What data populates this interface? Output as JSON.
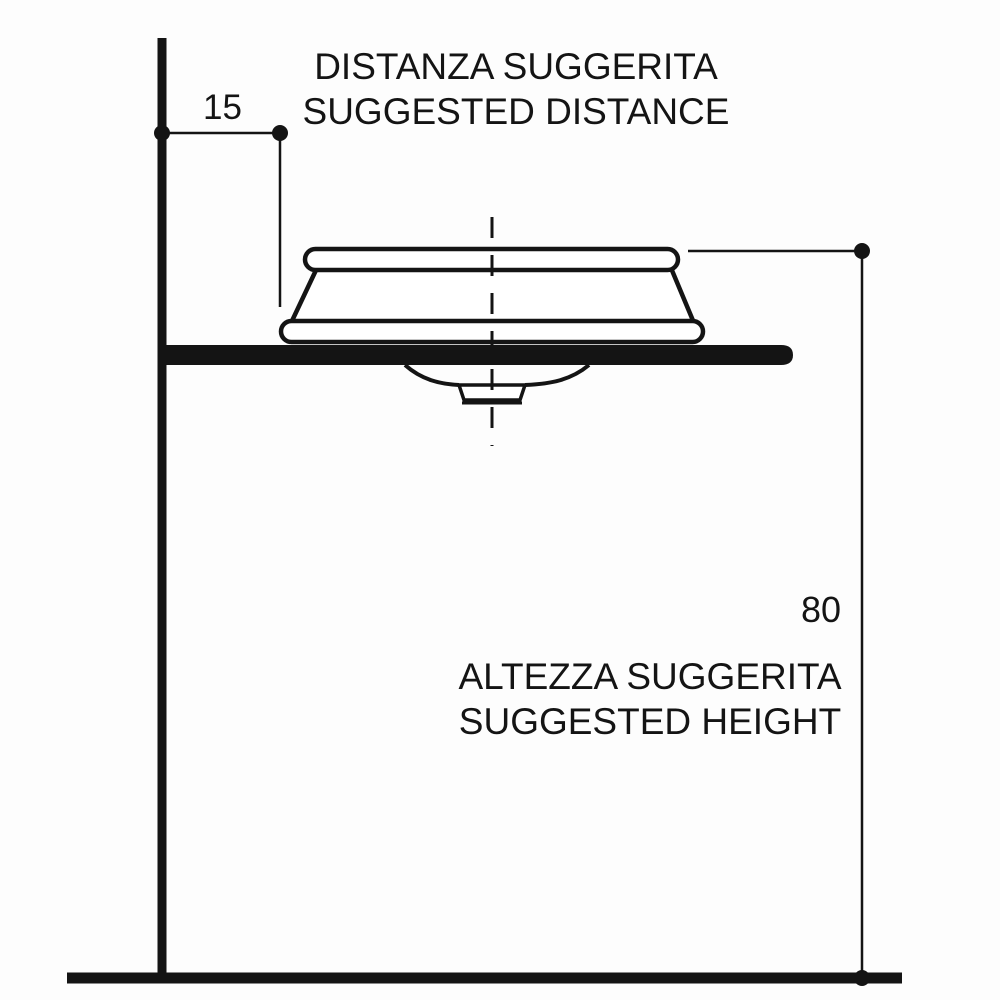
{
  "page": {
    "background": "#fdfdfd",
    "line_color": "#141414"
  },
  "diagram": {
    "type": "washbasin-installation-side-view",
    "distance_title": {
      "line1": "DISTANZA SUGGERITA",
      "line2": "SUGGESTED DISTANCE"
    },
    "height_title": {
      "line1": "ALTEZZA SUGGERITA",
      "line2": "SUGGESTED HEIGHT"
    },
    "dimensions": {
      "suggested_distance": "15",
      "suggested_height": "80"
    }
  }
}
